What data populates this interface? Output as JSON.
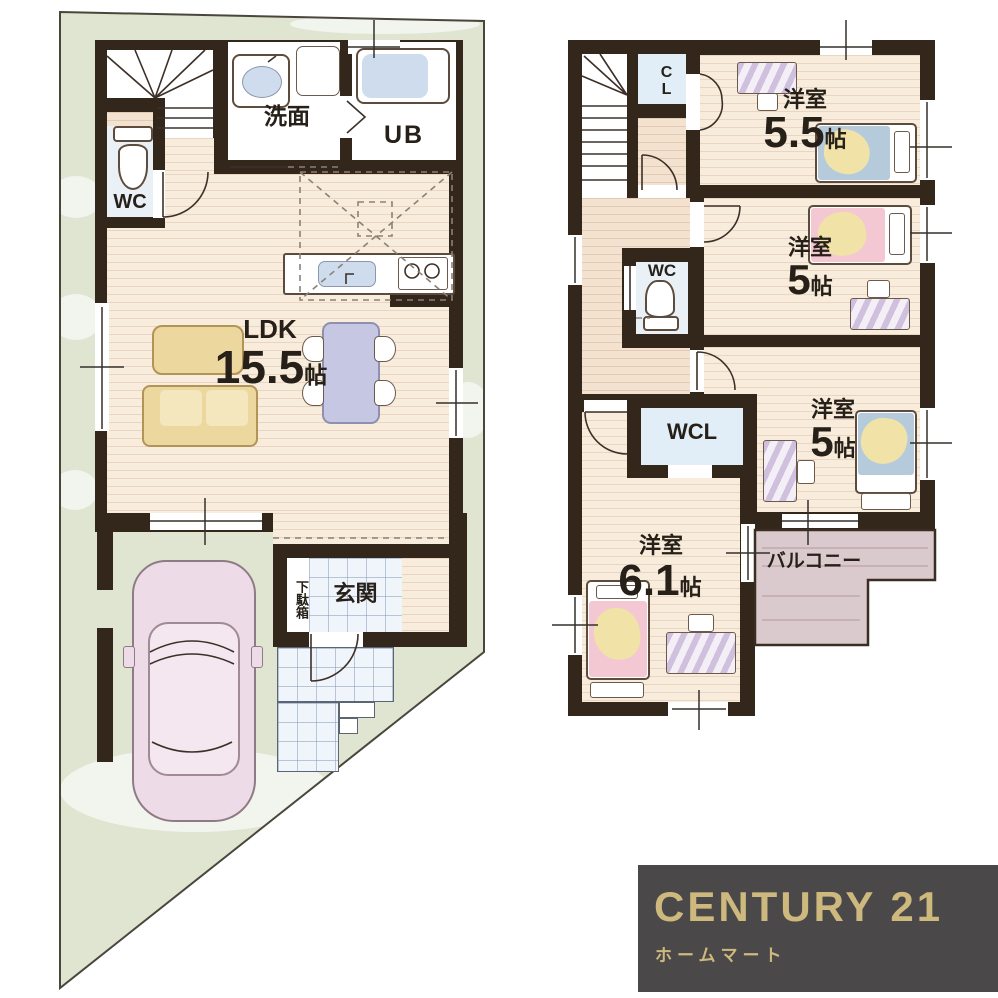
{
  "plan_1f": {
    "washroom_label": "洗面",
    "bath_label": "UB",
    "wc_label": "WC",
    "ldk_label": "LDK",
    "ldk_size": "15.5",
    "ldk_size_unit": "帖",
    "entrance_label": "玄関",
    "shoe_cabinet_label": "下駄箱"
  },
  "plan_2f": {
    "closet_label": "CL",
    "wc_label": "WC",
    "walkin_closet_label": "WCL",
    "balcony_label": "バルコニー",
    "room_a_label": "洋室",
    "room_a_size": "5.5",
    "room_a_unit": "帖",
    "room_b_label": "洋室",
    "room_b_size": "5",
    "room_b_unit": "帖",
    "room_c_label": "洋室",
    "room_c_size": "5",
    "room_c_unit": "帖",
    "room_d_label": "洋室",
    "room_d_size": "6.1",
    "room_d_unit": "帖"
  },
  "logo": {
    "brand": "CENTURY 21",
    "company": "ホームマート"
  },
  "colors": {
    "site_green": "#dfe5d1",
    "wall_dark": "#33261b",
    "wood_floor": "#f8ecdc",
    "tile_blue": "#f0f5fb",
    "closet_blue": "#e2eef7",
    "balcony_mauve": "#dac9cd",
    "bed_pink": "#f3c8d2",
    "bed_blue": "#b5cbdc",
    "blanket_yellow": "#f1e2a8",
    "sofa_yellow": "#ecd89e",
    "car_pink": "#eedbe8",
    "logo_bg": "#4a4849",
    "logo_gold": "#cdb87e"
  }
}
